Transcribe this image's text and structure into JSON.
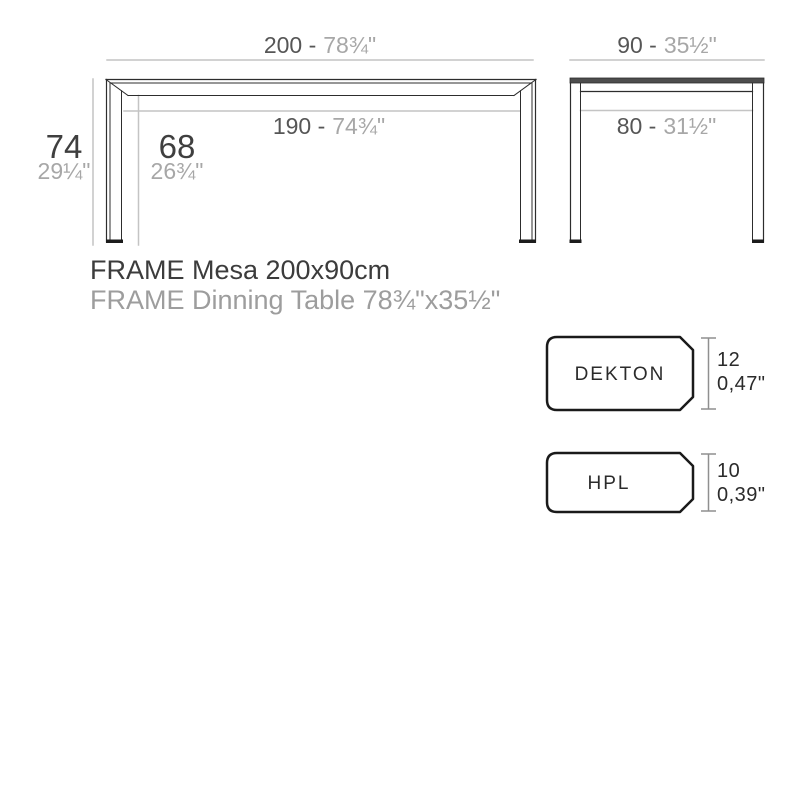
{
  "front_view": {
    "top_dim": {
      "cm": "200 -",
      "inch": "78¾\""
    },
    "inner_dim": {
      "cm": "190 -",
      "inch": "74¾\""
    },
    "height_dim": {
      "cm": "74",
      "inch": "29¼\""
    },
    "clearance_dim": {
      "cm": "68",
      "inch": "26¾\""
    }
  },
  "side_view": {
    "top_dim": {
      "cm": "90 -",
      "inch": "35½\""
    },
    "inner_dim": {
      "cm": "80 -",
      "inch": "31½\""
    }
  },
  "product": {
    "title": "FRAME Mesa 200x90cm",
    "subtitle": "FRAME Dinning Table 78¾\"x35½\""
  },
  "materials": [
    {
      "name": "DEKTON",
      "thickness_mm": "12",
      "thickness_inch": "0,47\""
    },
    {
      "name": "HPL",
      "thickness_mm": "10",
      "thickness_inch": "0,39\""
    }
  ],
  "colors": {
    "line_dark": "#2d2d2d",
    "line_light": "#c4c4c4",
    "tabletop_edge_fill": "#4d4d4d",
    "foot_fill": "#1c1c1c",
    "text_dark": "#565656",
    "text_light": "#a7a7a7",
    "badge_border": "#1a1a1a"
  }
}
